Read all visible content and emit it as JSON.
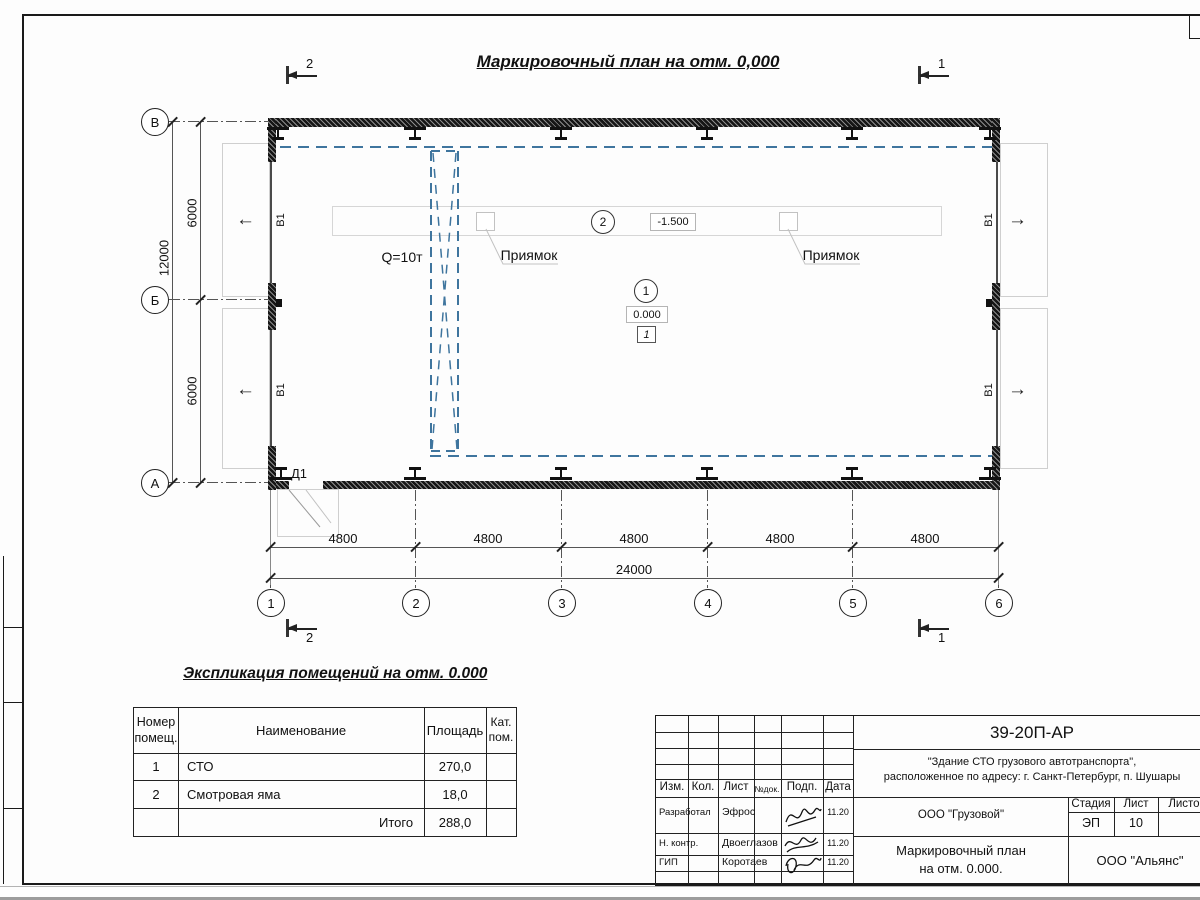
{
  "plan": {
    "title": "Маркировочный план на отм. 0,000",
    "axis_rows": [
      "В",
      "Б",
      "А"
    ],
    "axis_cols": [
      "1",
      "2",
      "3",
      "4",
      "5",
      "6"
    ],
    "dims": {
      "v1": "6000",
      "v2": "6000",
      "v_total": "12000",
      "h": [
        "4800",
        "4800",
        "4800",
        "4800",
        "4800"
      ],
      "h_total": "24000"
    },
    "sections": {
      "s1": "1",
      "s2": "2"
    },
    "labels": {
      "crane": "Q=10т",
      "pit1": "Приямок",
      "pit2": "Приямок",
      "door": "Д1",
      "window": "В1",
      "room1_num": "1",
      "room2_num": "2",
      "level_main": "0.000",
      "level_pit": "-1.500",
      "floor_mark": "1"
    }
  },
  "explication": {
    "title": "Экспликация помещений на отм. 0.000",
    "headers": {
      "num": "Номер помещ.",
      "name": "Наименование",
      "area": "Площадь",
      "cat": "Кат. пом."
    },
    "rows": [
      {
        "num": "1",
        "name": "СТО",
        "area": "270,0",
        "cat": ""
      },
      {
        "num": "2",
        "name": "Смотровая яма",
        "area": "18,0",
        "cat": ""
      }
    ],
    "total_label": "Итого",
    "total_area": "288,0"
  },
  "titleblock": {
    "doc_number": "39-20П-АР",
    "object_line1": "\"Здание СТО грузового автотранспорта\",",
    "object_line2": "расположенное по адресу: г. Санкт-Петербург, п. Шушары",
    "col_izm": "Изм.",
    "col_kol": "Кол.",
    "col_list": "Лист",
    "col_doc": "№док.",
    "col_podp": "Подп.",
    "col_data": "Дата",
    "roles": [
      {
        "role": "Разработал",
        "name": "Эфрос",
        "date": "11.20"
      },
      {
        "role": "Н. контр.",
        "name": "Двоеглазов",
        "date": "11.20"
      },
      {
        "role": "ГИП",
        "name": "Коротаев",
        "date": "11.20"
      }
    ],
    "company": "ООО \"Грузовой\"",
    "stage_label": "Стадия",
    "stage": "ЭП",
    "sheet_label": "Лист",
    "sheet": "10",
    "sheets_label": "Листов",
    "sheets": "",
    "drawing_name1": "Маркировочный план",
    "drawing_name2": "на отм. 0.000.",
    "org": "ООО \"Альянс\""
  }
}
